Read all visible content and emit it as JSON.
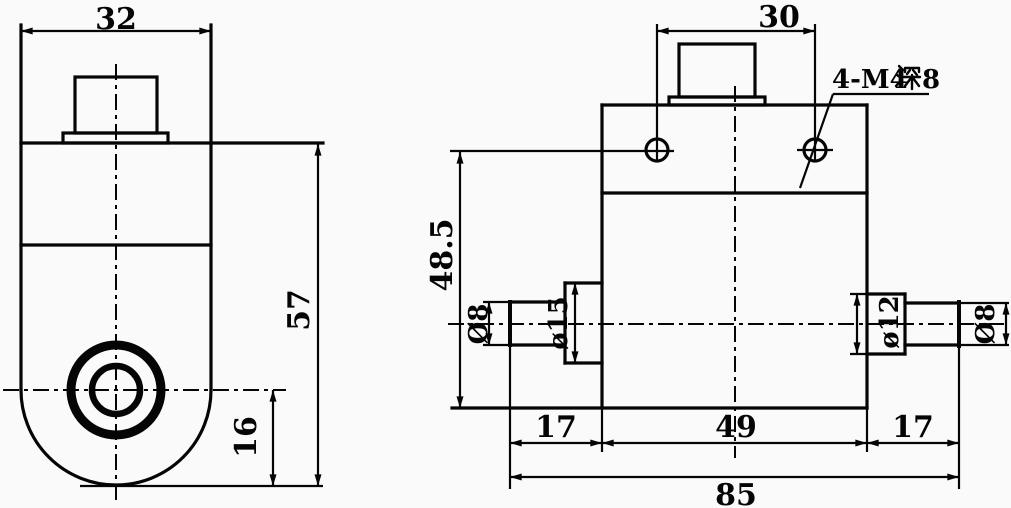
{
  "drawing": {
    "title": "dual-shaft sensor block engineering drawing",
    "colors": {
      "line": "#050505",
      "background": "#fafafa"
    },
    "left_view": {
      "width_label": "32",
      "height_label": "57",
      "bore_offset_label": "16"
    },
    "right_view": {
      "hole_spacing_label": "30",
      "thread_note_full": "4-M4深8",
      "thread_note_pre": "4-M4",
      "thread_note_cjk": "深",
      "thread_note_post": "8",
      "axis_height_label": "48.5",
      "left_shaft_dia_label": "Ø8",
      "left_collar_dia_label": "ø15",
      "right_collar_dia_label": "ø12",
      "right_shaft_dia_label": "Ø8",
      "left_block_label": "17",
      "body_width_label": "49",
      "right_block_label": "17",
      "overall_width_label": "85"
    }
  }
}
